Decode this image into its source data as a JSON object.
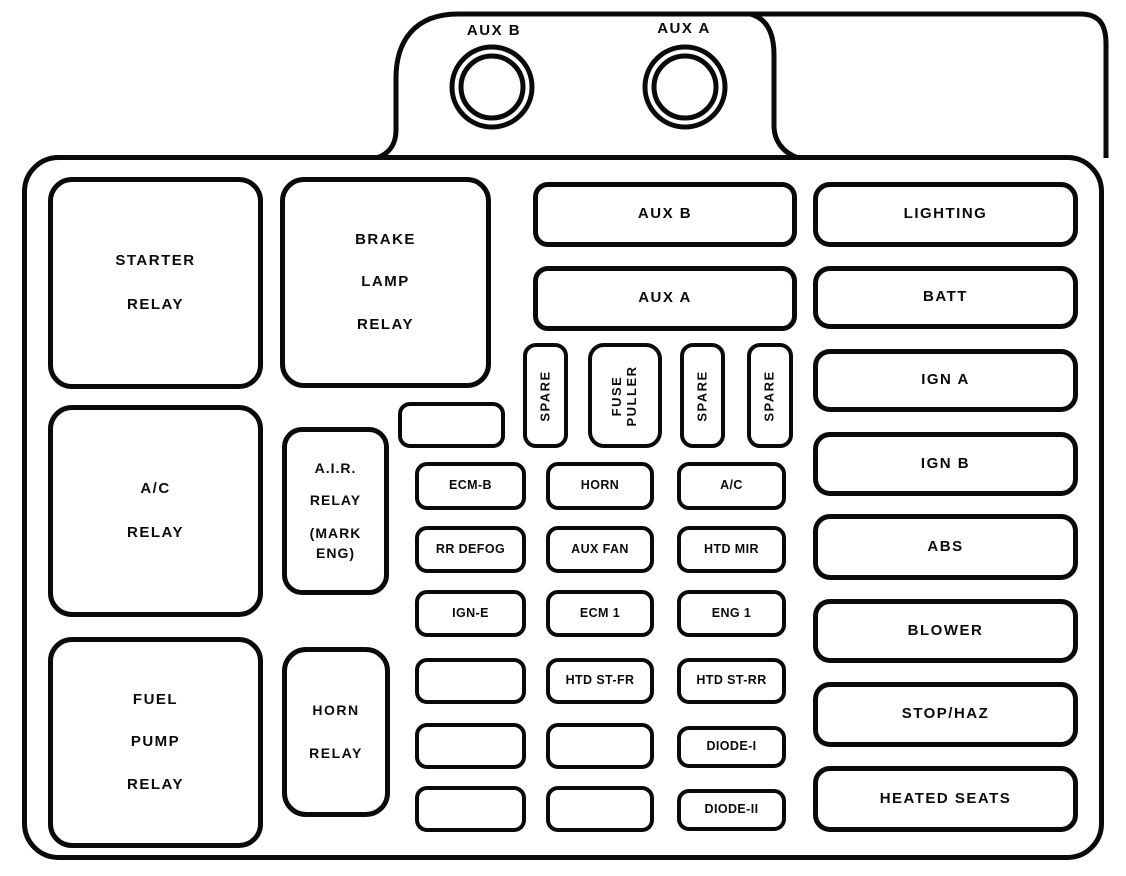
{
  "colors": {
    "line": "#000000",
    "background": "#ffffff"
  },
  "top_tab": {
    "aux_b_socket_label": "AUX B",
    "aux_a_socket_label": "AUX A"
  },
  "relays": {
    "starter": {
      "lines": [
        "STARTER",
        "RELAY"
      ]
    },
    "brake_lamp": {
      "lines": [
        "BRAKE",
        "LAMP",
        "RELAY"
      ]
    },
    "ac": {
      "lines": [
        "A/C",
        "RELAY"
      ]
    },
    "air": {
      "lines": [
        "A.I.R.",
        "RELAY",
        "(MARK",
        "ENG)"
      ]
    },
    "fuel_pump": {
      "lines": [
        "FUEL",
        "PUMP",
        "RELAY"
      ]
    },
    "horn": {
      "lines": [
        "HORN",
        "RELAY"
      ]
    }
  },
  "maxi_fuses": {
    "aux_b": "AUX B",
    "aux_a": "AUX A"
  },
  "slots": {
    "spare_1": "SPARE",
    "fuse_puller": {
      "lines": [
        "FUSE",
        "PULLER"
      ]
    },
    "spare_2": "SPARE",
    "spare_3": "SPARE",
    "blank": ""
  },
  "fuse_grid": {
    "rows": [
      [
        "ECM-B",
        "HORN",
        "A/C"
      ],
      [
        "RR DEFOG",
        "AUX FAN",
        "HTD MIR"
      ],
      [
        "IGN-E",
        "ECM 1",
        "ENG 1"
      ],
      [
        "",
        "HTD ST-FR",
        "HTD ST-RR"
      ],
      [
        "",
        "",
        "DIODE-I"
      ],
      [
        "",
        "",
        "DIODE-II"
      ]
    ]
  },
  "right_column": [
    "LIGHTING",
    "BATT",
    "IGN A",
    "IGN B",
    "ABS",
    "BLOWER",
    "STOP/HAZ",
    "HEATED SEATS"
  ]
}
